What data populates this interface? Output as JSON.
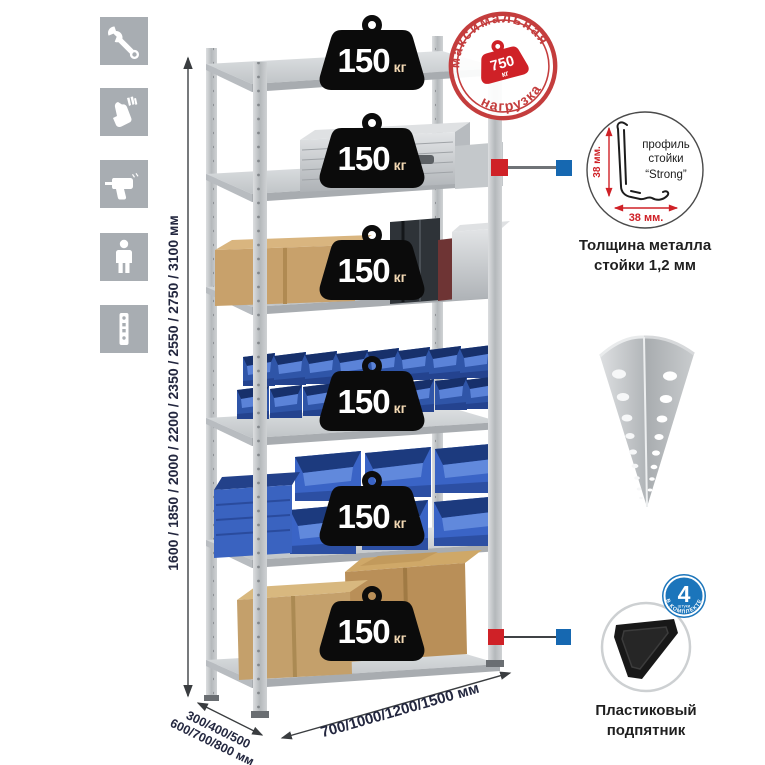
{
  "sidebar": {
    "icons": [
      {
        "name": "wrench-icon"
      },
      {
        "name": "gloves-icon"
      },
      {
        "name": "drill-icon"
      },
      {
        "name": "person-icon"
      },
      {
        "name": "perforated-strip-icon"
      }
    ]
  },
  "dimensions": {
    "height_label": "1600 / 1850 / 2000 / 2200 / 2350 / 2550 / 2750 / 3100 мм",
    "depth_label_line1": "300/400/500",
    "depth_label_line2": "600/700/800 мм",
    "width_label": "700/1000/1200/1500 мм"
  },
  "weights": {
    "unit": "кг",
    "values": [
      "150",
      "150",
      "150",
      "150",
      "150",
      "150"
    ]
  },
  "max_load_stamp": {
    "arc_top": "максимальная",
    "arc_bottom": "нагрузка",
    "value": "750",
    "unit": "кг"
  },
  "profile_callout": {
    "label_line1": "профиль",
    "label_line2": "стойки",
    "label_line3": "“Strong”",
    "vertical_dim": "38 мм.",
    "horizontal_dim": "38 мм.",
    "caption_line1": "Толщина металла",
    "caption_line2": "стойки 1,2 мм"
  },
  "foot_callout": {
    "badge_number": "4",
    "badge_small_text": "штуки",
    "badge_arc_text": "В КОМПЛЕКТЕ",
    "caption_line1": "Пластиковый",
    "caption_line2": "подпятник"
  },
  "colors": {
    "accent_red": "#cf2127",
    "accent_blue": "#1668b1",
    "stamp_red": "#c43d3d",
    "badge_blue": "#1b75bb",
    "dim_text": "#23273f",
    "caption_text": "#1f1f1f",
    "tile_gray": "#a8adb2"
  }
}
